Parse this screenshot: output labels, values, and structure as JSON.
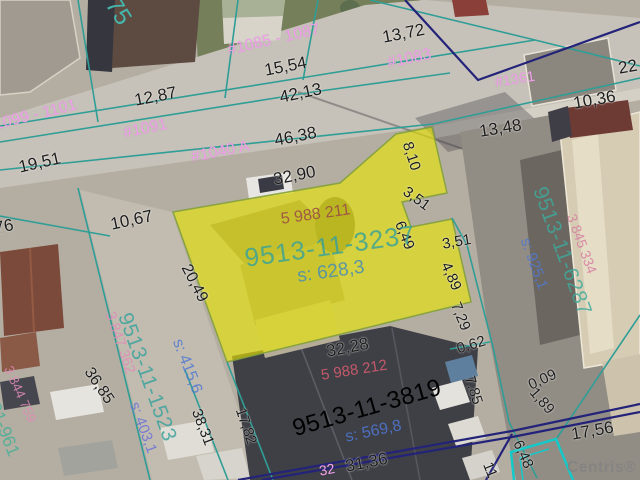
{
  "watermark": {
    "text": "Centris®"
  },
  "colors": {
    "boundary_teal": "#2f9e96",
    "boundary_bright_teal": "#15c9c9",
    "boundary_navy": "#23237a",
    "lot_highlight_yellow": "#e9e400",
    "address_pink": "#efa0ea",
    "measure_black": "#1c1c1c"
  },
  "labels": {
    "measurements": [
      {
        "text": "19,51",
        "x": 17,
        "y": 159,
        "rot": -13,
        "size": 17
      },
      {
        "text": "12,87",
        "x": 133,
        "y": 92,
        "rot": -11,
        "size": 17
      },
      {
        "text": "15,54",
        "x": 263,
        "y": 62,
        "rot": -11,
        "size": 17
      },
      {
        "text": "42,13",
        "x": 278,
        "y": 89,
        "rot": -12,
        "size": 17
      },
      {
        "text": "13,72",
        "x": 381,
        "y": 29,
        "rot": -11,
        "size": 17
      },
      {
        "text": "46,38",
        "x": 273,
        "y": 132,
        "rot": -11,
        "size": 17
      },
      {
        "text": "32,90",
        "x": 272,
        "y": 171,
        "rot": -11,
        "size": 17
      },
      {
        "text": "13,48",
        "x": 478,
        "y": 123,
        "rot": -9,
        "size": 17
      },
      {
        "text": "10,36",
        "x": 572,
        "y": 95,
        "rot": -10,
        "size": 17
      },
      {
        "text": "22",
        "x": 617,
        "y": 60,
        "rot": -10,
        "size": 17
      },
      {
        "text": "10,67",
        "x": 109,
        "y": 216,
        "rot": -12,
        "size": 17
      },
      {
        "text": "76",
        "x": -7,
        "y": 220,
        "rot": -12,
        "size": 17
      },
      {
        "text": "8,10",
        "x": 414,
        "y": 140,
        "rot": 72,
        "size": 15
      },
      {
        "text": "3,51",
        "x": 409,
        "y": 184,
        "rot": 36,
        "size": 15
      },
      {
        "text": "6,49",
        "x": 406,
        "y": 219,
        "rot": 68,
        "size": 15
      },
      {
        "text": "3,51",
        "x": 441,
        "y": 237,
        "rot": -10,
        "size": 15
      },
      {
        "text": "4,89",
        "x": 452,
        "y": 260,
        "rot": 66,
        "size": 15
      },
      {
        "text": "7,29",
        "x": 462,
        "y": 300,
        "rot": 68,
        "size": 15
      },
      {
        "text": "0,62",
        "x": 455,
        "y": 342,
        "rot": -17,
        "size": 15
      },
      {
        "text": "7,85",
        "x": 476,
        "y": 374,
        "rot": 72,
        "size": 15
      },
      {
        "text": "0,09",
        "x": 526,
        "y": 379,
        "rot": -25,
        "size": 15
      },
      {
        "text": "1,89",
        "x": 538,
        "y": 385,
        "rot": 49,
        "size": 15
      },
      {
        "text": "17,56",
        "x": 570,
        "y": 426,
        "rot": -10,
        "size": 17
      },
      {
        "text": "6,48",
        "x": 524,
        "y": 438,
        "rot": 66,
        "size": 15
      },
      {
        "text": "11",
        "x": 494,
        "y": 460,
        "rot": 68,
        "size": 15
      },
      {
        "text": "31,36",
        "x": 344,
        "y": 458,
        "rot": -11,
        "size": 17
      },
      {
        "text": "32,28",
        "x": 325,
        "y": 343,
        "rot": -11,
        "size": 17
      },
      {
        "text": "17,82",
        "x": 247,
        "y": 406,
        "rot": 71,
        "size": 15
      },
      {
        "text": "38,31",
        "x": 203,
        "y": 407,
        "rot": 69,
        "size": 15
      },
      {
        "text": "36,85",
        "x": 94,
        "y": 365,
        "rot": 56,
        "size": 16
      },
      {
        "text": "20,49",
        "x": 192,
        "y": 262,
        "rot": 63,
        "size": 16
      }
    ],
    "addresses": [
      {
        "text": "#1099 - 1101",
        "x": -16,
        "y": 120,
        "rot": -14,
        "size": 16
      },
      {
        "text": "#1091",
        "x": 122,
        "y": 126,
        "rot": -12,
        "size": 16
      },
      {
        "text": "#1085 - 1087",
        "x": 226,
        "y": 43,
        "rot": -13,
        "size": 16
      },
      {
        "text": "#1083",
        "x": 386,
        "y": 56,
        "rot": -12,
        "size": 16
      },
      {
        "text": "#1361",
        "x": 494,
        "y": 76,
        "rot": -9,
        "size": 14.5
      },
      {
        "text": "#1040 A",
        "x": 190,
        "y": 150,
        "rot": -11,
        "size": 16
      },
      {
        "text": "75",
        "x": 121,
        "y": -6,
        "rot": 58,
        "size": 24,
        "color": "#45b8ae"
      },
      {
        "text": "32",
        "x": 318,
        "y": 464,
        "rot": -11,
        "size": 14
      }
    ],
    "parcels": [
      {
        "text": "5 988 211",
        "x": 280,
        "y": 212,
        "rot": -8,
        "size": 16,
        "color": "rgba(154,79,68,.9)"
      },
      {
        "text": "9513-11-3237",
        "x": 243,
        "y": 245,
        "rot": -8,
        "size": 26,
        "color": "rgba(52,160,155,.8)",
        "ls": 1
      },
      {
        "text": "s: 628,3",
        "x": 296,
        "y": 267,
        "rot": -8,
        "size": 19,
        "color": "rgba(70,140,180,.85)"
      },
      {
        "text": "5 988 212",
        "x": 320,
        "y": 368,
        "rot": -9,
        "size": 15,
        "color": "rgba(228,95,115,.8)"
      },
      {
        "text": "9513-11-3819",
        "x": 290,
        "y": 418,
        "rot": -16,
        "size": 24,
        "color": "rgba(170,214,180,.85),",
        "ls": 0.5
      },
      {
        "text": "s: 569,8",
        "x": 344,
        "y": 430,
        "rot": -12,
        "size": 16,
        "color": "rgba(80,120,210,.85)"
      },
      {
        "text": "9513-11-6287",
        "x": 549,
        "y": 184,
        "rot": 70,
        "size": 21,
        "color": "rgba(60,170,155,.8)",
        "ls": 0.5
      },
      {
        "text": "3 845 334",
        "x": 578,
        "y": 212,
        "rot": 70,
        "size": 14,
        "color": "rgba(214,125,160,.85)"
      },
      {
        "text": "s: 925,1",
        "x": 532,
        "y": 236,
        "rot": 70,
        "size": 15,
        "color": "rgba(80,120,210,.85)"
      },
      {
        "text": "9513-11-1523",
        "x": 134,
        "y": 310,
        "rot": 70,
        "size": 21,
        "color": "rgba(52,160,155,.8)",
        "ls": 0.5
      },
      {
        "text": "3 847 362",
        "x": 116,
        "y": 310,
        "rot": 71,
        "size": 14.5,
        "color": "rgba(224,138,184,.85)"
      },
      {
        "text": "s: 415,6",
        "x": 184,
        "y": 337,
        "rot": 69,
        "size": 16,
        "color": "rgba(80,120,210,.85)"
      },
      {
        "text": "s: 403,1",
        "x": 141,
        "y": 400,
        "rot": 70,
        "size": 15,
        "color": "rgba(110,116,214,.9)"
      },
      {
        "text": "3 844 759",
        "x": 14,
        "y": 364,
        "rot": 66,
        "size": 13.5,
        "color": "rgba(224,138,184,.85)"
      },
      {
        "text": "3-01-961",
        "x": -4,
        "y": 385,
        "rot": 68,
        "size": 18,
        "color": "rgba(70,175,150,.85)"
      }
    ]
  }
}
